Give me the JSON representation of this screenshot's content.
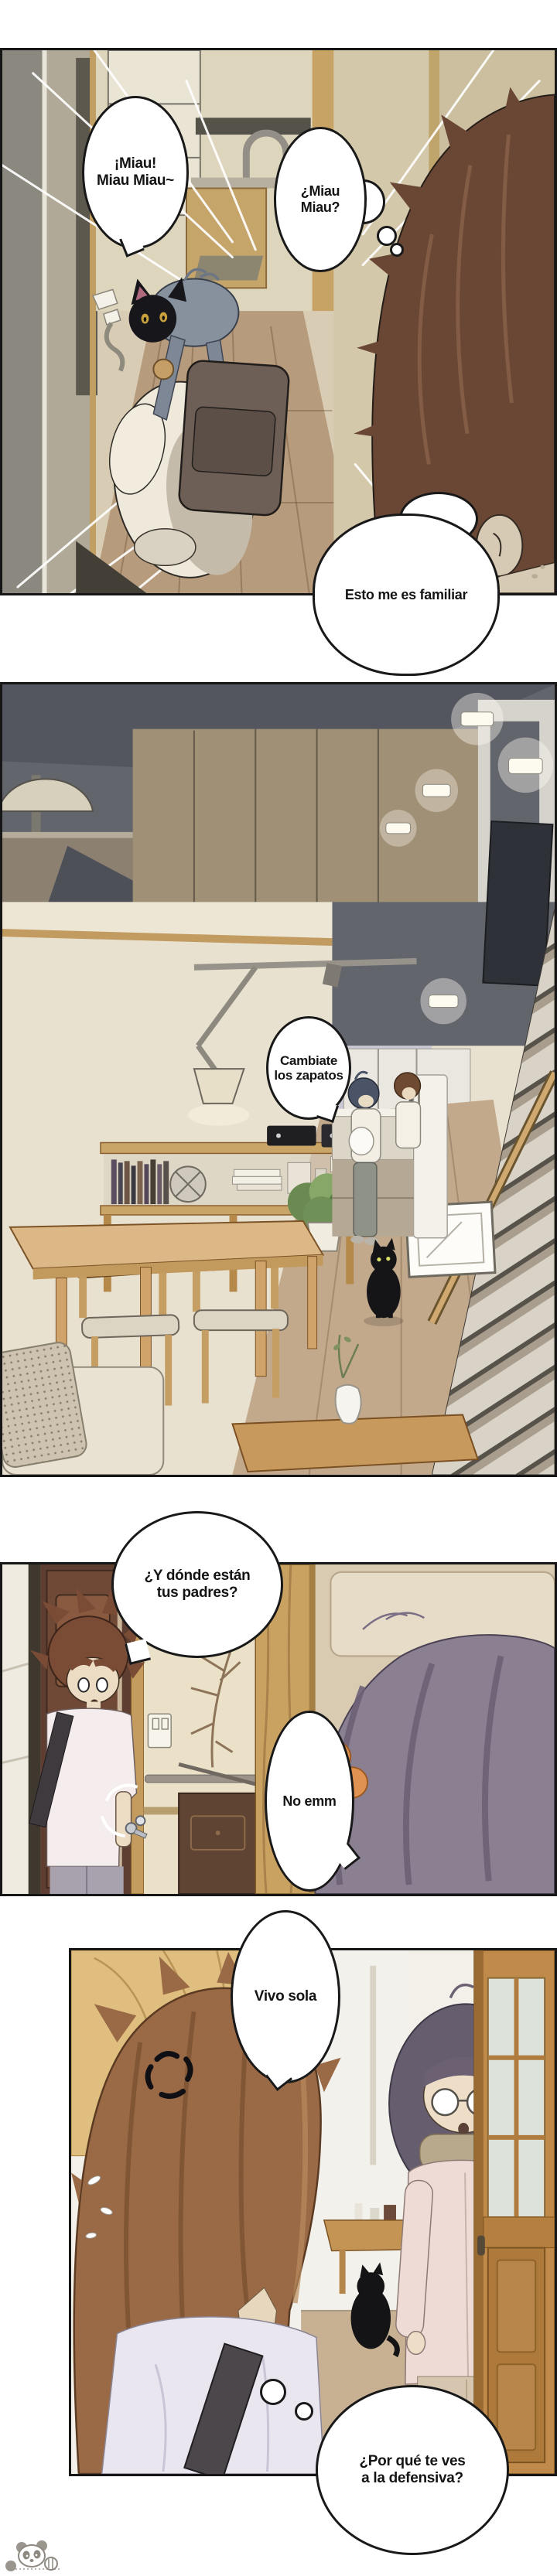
{
  "comic": {
    "language": "es",
    "panels": [
      {
        "bubbles": [
          {
            "style": "speech",
            "lines": [
              "¡Miau!",
              "Miau Miau~"
            ]
          },
          {
            "style": "thought",
            "lines": [
              "¿Miau",
              "Miau?"
            ]
          },
          {
            "style": "speech",
            "lines": [
              "Esto me es familiar"
            ]
          }
        ]
      },
      {
        "bubbles": [
          {
            "style": "speech",
            "lines": [
              "Cambiate",
              "los zapatos"
            ]
          }
        ]
      },
      {
        "bubbles": [
          {
            "style": "speech",
            "lines": [
              "¿Y dónde están",
              "tus padres?"
            ]
          },
          {
            "style": "speech",
            "lines": [
              "No emm"
            ]
          }
        ]
      },
      {
        "bubbles": [
          {
            "style": "speech",
            "lines": [
              "Vivo sola"
            ]
          },
          {
            "style": "thought",
            "lines": [
              "¿Por qué te ves",
              "a la defensiva?"
            ]
          }
        ]
      }
    ],
    "watermark_icon": "panda-mascot-icon",
    "colors": {
      "bubble_border": "#191919",
      "panel_border": "#161616",
      "boy_hair_brown": "#9a6a47",
      "girl_hair_gray_blue": "#87909d",
      "girl_hair_purple": "#6b6173",
      "hair_tie_orange": "#e09252",
      "cat_black": "#17171b",
      "wood_tan": "#c9a265",
      "floor_wood": "#b79b7d"
    }
  }
}
